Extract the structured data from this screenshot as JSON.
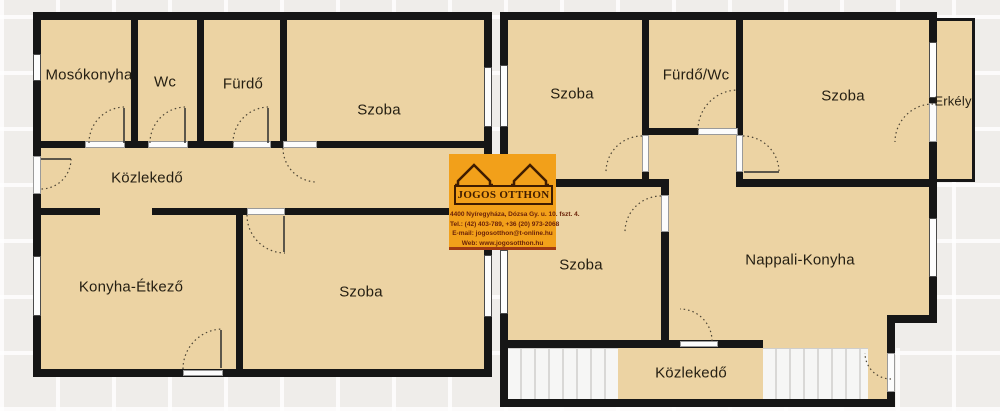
{
  "rooms": [
    {
      "id": "mosokonyha",
      "label": "Mosókonyha"
    },
    {
      "id": "wc",
      "label": "Wc"
    },
    {
      "id": "furdo",
      "label": "Fürdő"
    },
    {
      "id": "szoba-top-left",
      "label": "Szoba"
    },
    {
      "id": "kozlekedo-left",
      "label": "Közlekedő"
    },
    {
      "id": "konyha-etkezo",
      "label": "Konyha-Étkező"
    },
    {
      "id": "szoba-bottom-left",
      "label": "Szoba"
    },
    {
      "id": "szoba-right-1",
      "label": "Szoba"
    },
    {
      "id": "furdo-wc",
      "label": "Fürdő/Wc"
    },
    {
      "id": "szoba-right-2",
      "label": "Szoba"
    },
    {
      "id": "erkely",
      "label": "Erkély"
    },
    {
      "id": "szoba-right-3",
      "label": "Szoba"
    },
    {
      "id": "nappali-konyha",
      "label": "Nappali-Konyha"
    },
    {
      "id": "kozlekedo-right",
      "label": "Közlekedő"
    }
  ],
  "watermark": {
    "brand": "JOGOS OTTHON",
    "address": "4400 Nyíregyháza, Dózsa Gy. u. 10. fszt. 4.",
    "phone": "Tel.: (42) 403-789, +36 (20) 973-2068",
    "email": "E-mail: jogosotthon@t-online.hu",
    "web": "Web: www.jogosotthon.hu"
  },
  "colors": {
    "background": "#efedea",
    "room_fill": "#ecd3a3",
    "wall": "#161616",
    "window": "#fdfdfd",
    "watermark_orange": "#f2a01a",
    "watermark_text": "#3f1c00"
  }
}
